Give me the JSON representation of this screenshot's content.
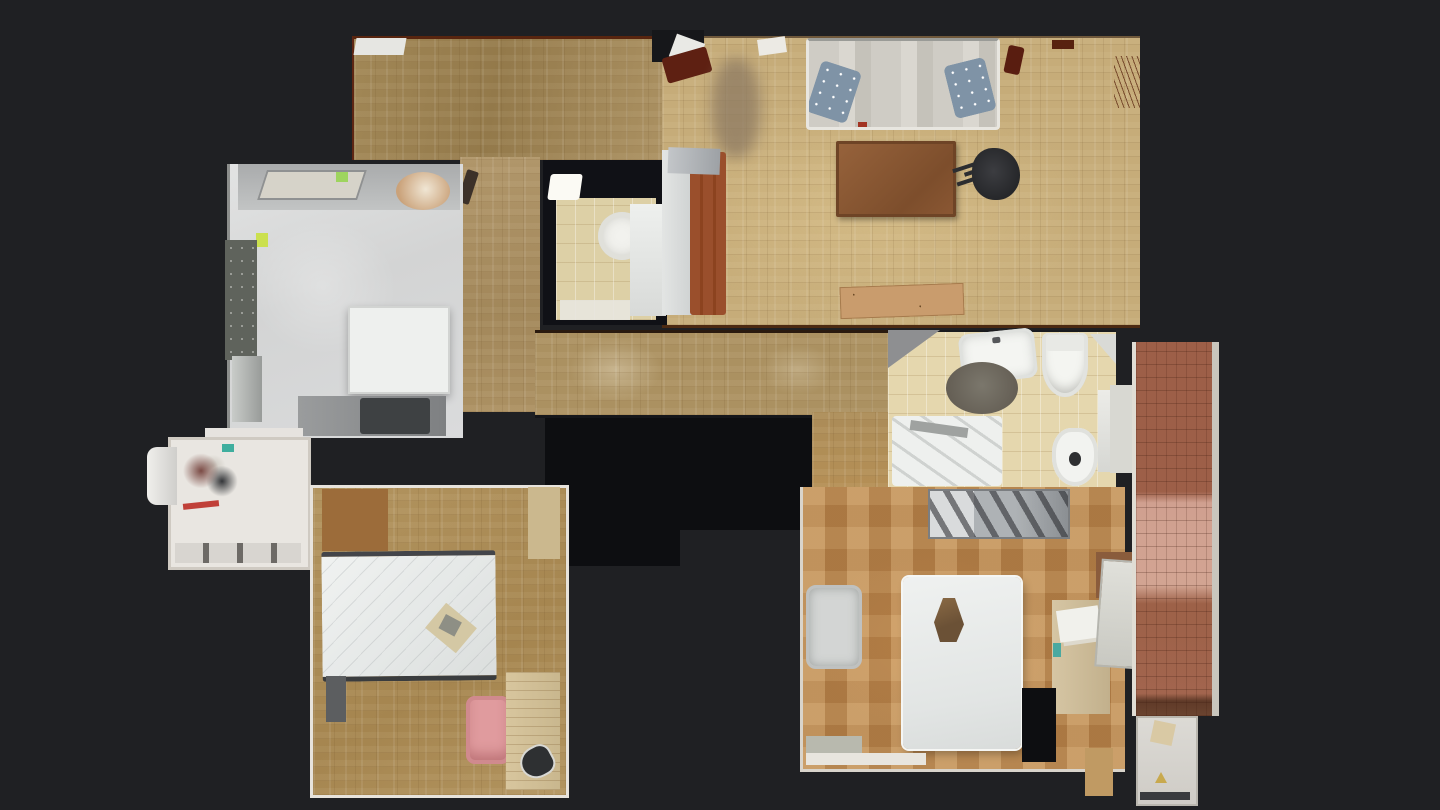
{
  "scene": {
    "type": "photogrammetry-floorplan-top-down-view",
    "description": "Top-down 3D-scan dollhouse floor plan of an apartment on a dark background",
    "background_color": "#1f2023"
  },
  "colors": {
    "bg": "#1f2023",
    "void": "#0d0e11",
    "parquetDark": "#a18756",
    "parquetLight": "#c6ac79",
    "parquetHall": "#ab9161",
    "parquetBedroomL": "#b2945f",
    "parquetBedroomR": "#b5834c",
    "kitchenFloor": "#d3d4d4",
    "bathTile": "#e5d7ae",
    "brick": "#9d5f48",
    "brickLight": "#d0a090",
    "brickDark": "#5f3a28",
    "sofa": "#cfccc5",
    "pillow": "#7f93a6",
    "table": "#8a5733",
    "bedFrame": "#9a4f2c",
    "mattress": "#eceeec",
    "chairBlack": "#26272a",
    "chairPink": "#e09b9e",
    "granite": "#5f635c",
    "wallWhite": "#e7e3dc",
    "rug": "#655f55",
    "plank": "#c99c6d",
    "desk": "#d6c6a4",
    "lampBrown": "#6b5136",
    "whiteFixture": "#f2f3f0",
    "noteGreen": "#9ed45e",
    "teal": "#3fae9e",
    "blur": "#8d7a62"
  },
  "regions": [
    {
      "name": "top-hall-band"
    },
    {
      "name": "living-room"
    },
    {
      "name": "kitchen"
    },
    {
      "name": "utility-room"
    },
    {
      "name": "guest-toilet"
    },
    {
      "name": "bed-nook"
    },
    {
      "name": "central-hallway"
    },
    {
      "name": "bathroom"
    },
    {
      "name": "bedroom-bottom-left"
    },
    {
      "name": "bedroom-bottom-right"
    },
    {
      "name": "balcony"
    },
    {
      "name": "balcony-storage"
    }
  ],
  "furniture": [
    "sofa",
    "throw-pillows",
    "coffee-table",
    "office-chair",
    "wood-plank",
    "kitchen-island",
    "granite-counter",
    "washing-machine",
    "mattress-bed",
    "pink-chair",
    "clothes-iron",
    "sink",
    "round-rug",
    "toilet",
    "bidet",
    "bathtub",
    "wardrobe",
    "double-bed",
    "bedside-lamp",
    "armchair",
    "desk"
  ]
}
